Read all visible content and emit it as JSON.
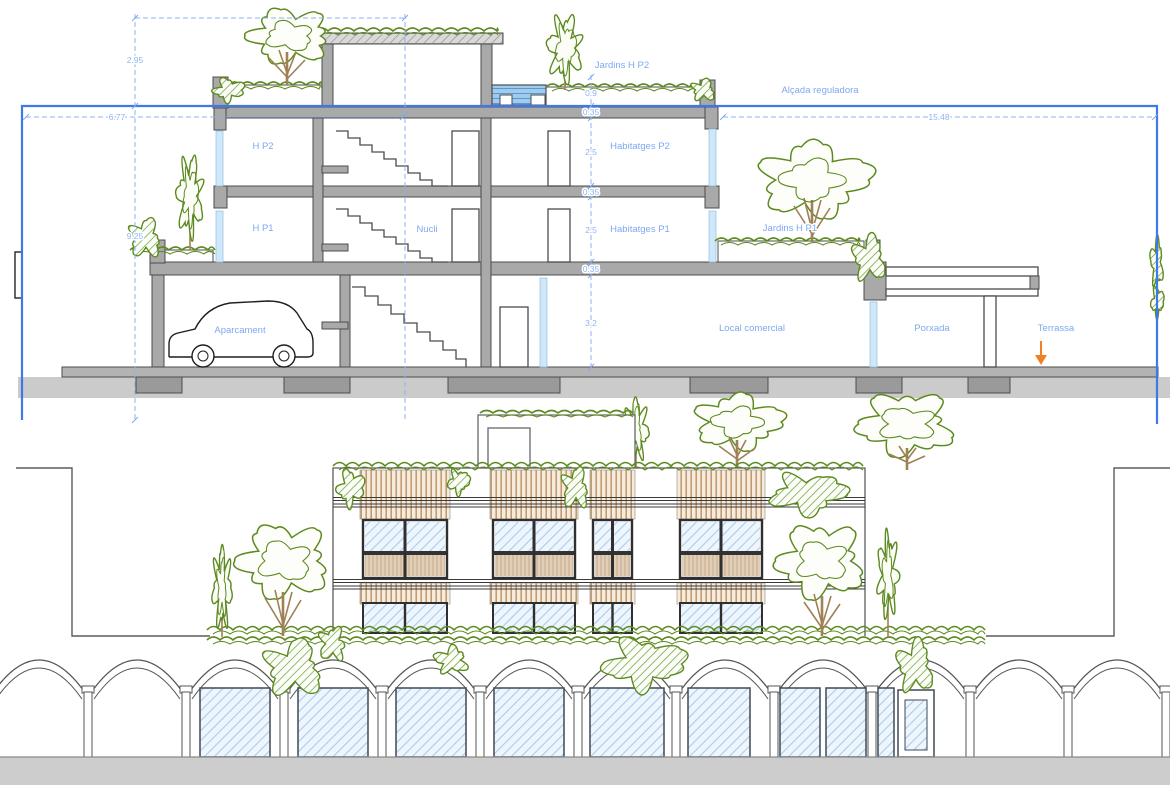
{
  "section": {
    "labels": {
      "hp2": "H P2",
      "hp1": "H P1",
      "nucli": "Nucli",
      "aparcament": "Aparcament",
      "jardins_hp2": "Jardins H P2",
      "jardins_hp1": "Jardins H P1",
      "habitatges_p2": "Habitatges P2",
      "habitatges_p1": "Habitatges P1",
      "local_comercial": "Local comercial",
      "porxada": "Porxada",
      "terrassa": "Terrassa",
      "alcada_reguladora": "Alçada reguladora"
    },
    "dimensions": {
      "tower_height": "2.95",
      "left_width": "6.77",
      "regulatory_height": "9.25",
      "right_width": "15.48",
      "roof_parapet": "0.9",
      "slab_top": "0.35",
      "floor_p2": "2.5",
      "slab_mid": "0.35",
      "floor_p1": "2.5",
      "slab_low": "0.35",
      "ground_floor": "3.2"
    },
    "colors": {
      "dimension_blue": "#8fb4f4",
      "label_blue": "#7da8f2",
      "envelope_blue": "#3f78e8",
      "wall_grey": "#a9a9a9",
      "vegetation_green": "#5d8a20",
      "water_blue": "#9fcbef",
      "entrance_arrow_orange": "#f08226",
      "wood_slat_tan": "#c39b72",
      "window_hatch_blue": "#a9cdec"
    }
  }
}
